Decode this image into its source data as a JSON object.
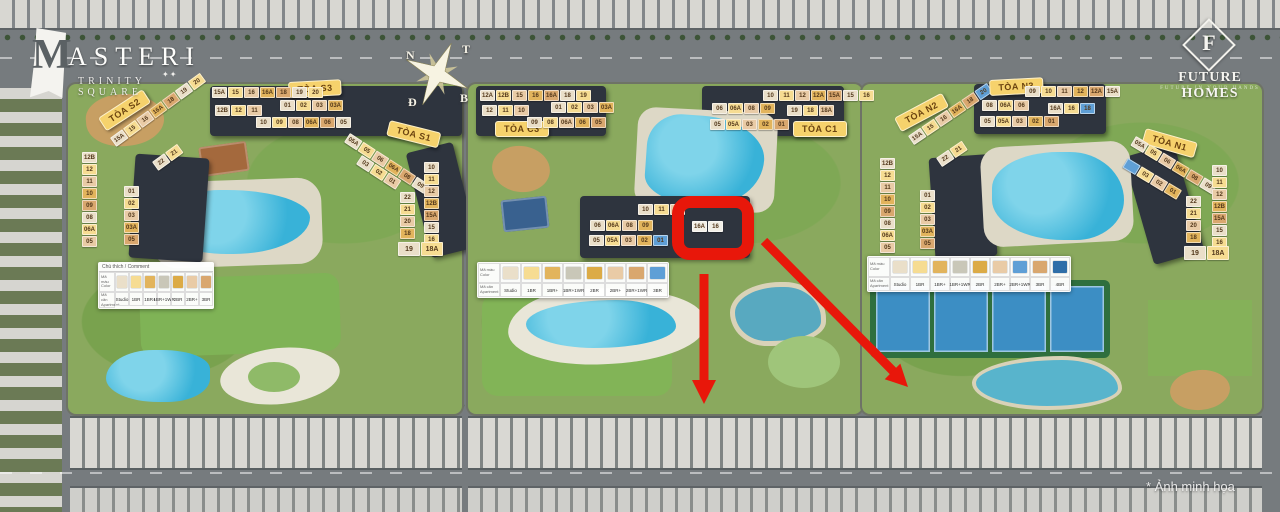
{
  "branding": {
    "masteri_m": "M",
    "masteri_rest": "ASTERI",
    "masteri_subtitle": "TRINITY SQUARE",
    "masteri_stars": "✦✦",
    "fh_monogram": "F",
    "fh_name": "FUTURE HOMES",
    "fh_tagline": "FUTURE IN YOUR HANDS"
  },
  "compass": {
    "tl": "N",
    "tr": "T",
    "bl": "Đ",
    "br": "B"
  },
  "watermark": "* Ảnh minh họa",
  "palette": {
    "st": "#eadfc9",
    "y1": "#f6dc92",
    "y2": "#e2b45c",
    "g2": "#dcab46",
    "t1": "#e9cba6",
    "t2": "#d9a76e",
    "gr": "#c9c7b8",
    "bl": "#5f9fd6",
    "b2": "#2f6ea8",
    "wh": "#f2efe6",
    "highlight_red": "#e8170a",
    "label_bg": "#f6d26c",
    "label_text": "#6b430f"
  },
  "legend_headers": {
    "color_vi": "Mã màu",
    "color_en": "Color",
    "apt_vi": "Mã căn",
    "apt_en": "Apartment"
  },
  "legends": [
    {
      "id": "left",
      "title": "Chú thích / Comment",
      "x": 98,
      "y": 262,
      "cell": 14,
      "hw": 16,
      "items": [
        {
          "label": "Studio",
          "c": "st"
        },
        {
          "label": "1BR",
          "c": "y1"
        },
        {
          "label": "1BR+",
          "c": "y2"
        },
        {
          "label": "1BR+1WR",
          "c": "gr"
        },
        {
          "label": "2BR",
          "c": "g2"
        },
        {
          "label": "2BR+",
          "c": "t1"
        },
        {
          "label": "3BR",
          "c": "t2"
        }
      ]
    },
    {
      "id": "center",
      "title": "",
      "x": 477,
      "y": 262,
      "cell": 21,
      "hw": 22,
      "items": [
        {
          "label": "Studio",
          "c": "st"
        },
        {
          "label": "1BR",
          "c": "y1"
        },
        {
          "label": "1BR+",
          "c": "y2"
        },
        {
          "label": "1BR+1WR",
          "c": "gr"
        },
        {
          "label": "2BR",
          "c": "g2"
        },
        {
          "label": "2BR+",
          "c": "t1"
        },
        {
          "label": "2BR+1WR",
          "c": "t2"
        },
        {
          "label": "3BR",
          "c": "bl"
        }
      ]
    },
    {
      "id": "right",
      "title": "",
      "x": 867,
      "y": 256,
      "cell": 20,
      "hw": 22,
      "items": [
        {
          "label": "Studio",
          "c": "st"
        },
        {
          "label": "1BR",
          "c": "y1"
        },
        {
          "label": "1BR+",
          "c": "y2"
        },
        {
          "label": "1BR+1WR",
          "c": "gr"
        },
        {
          "label": "2BR",
          "c": "g2"
        },
        {
          "label": "2BR+",
          "c": "t1"
        },
        {
          "label": "2BR+1WR",
          "c": "bl"
        },
        {
          "label": "3BR",
          "c": "t2"
        },
        {
          "label": "4BR",
          "c": "b2"
        }
      ]
    }
  ],
  "buildings": [
    {
      "id": "S2",
      "label": "TÒA S2",
      "lx": 98,
      "ly": 118,
      "lrot": -33,
      "groups": [
        {
          "x": 110,
          "y": 138,
          "rot": -36,
          "tiles": [
            "15A",
            "15",
            "16",
            "16A",
            "18",
            "19",
            "20"
          ]
        },
        {
          "x": 152,
          "y": 162,
          "rot": -36,
          "tiles": [
            "22",
            "21"
          ]
        },
        {
          "x": 82,
          "y": 152,
          "dir": "col",
          "tiles": [
            "12B",
            "12",
            "11",
            "10",
            "09",
            "08",
            "06A",
            "05"
          ]
        },
        {
          "x": 124,
          "y": 186,
          "dir": "col",
          "tiles": [
            "01",
            "02",
            "03",
            "03A",
            "05"
          ]
        }
      ]
    },
    {
      "id": "S3",
      "label": "TÒA S3",
      "lx": 288,
      "ly": 82,
      "lrot": -3,
      "groups": [
        {
          "x": 212,
          "y": 87,
          "tiles": [
            "15A",
            "15",
            "16",
            "16A",
            "18",
            "19",
            "20"
          ]
        },
        {
          "x": 215,
          "y": 105,
          "tiles": [
            "12B",
            "12",
            "11"
          ]
        },
        {
          "x": 280,
          "y": 100,
          "tiles": [
            "01",
            "02",
            "03",
            "03A"
          ]
        },
        {
          "x": 256,
          "y": 117,
          "tiles": [
            "10",
            "09",
            "08",
            "06A",
            "06",
            "05"
          ]
        }
      ]
    },
    {
      "id": "S1",
      "label": "TÒA S1",
      "lx": 390,
      "ly": 120,
      "lrot": 14,
      "groups": [
        {
          "x": 350,
          "y": 133,
          "rot": 33,
          "tiles": [
            "05A",
            "05",
            "06",
            "06A",
            "08",
            "09"
          ]
        },
        {
          "x": 362,
          "y": 155,
          "rot": 33,
          "tiles": [
            "03",
            "02",
            "01"
          ]
        },
        {
          "x": 424,
          "y": 162,
          "dir": "col",
          "tiles": [
            "10",
            "11",
            "12",
            "12B",
            "15A",
            "15",
            "16"
          ]
        },
        {
          "x": 400,
          "y": 192,
          "dir": "col",
          "tiles": [
            "22",
            "21",
            "20",
            "18"
          ]
        },
        {
          "x": 398,
          "y": 242,
          "wide": true,
          "tiles": [
            "19",
            "18A"
          ]
        }
      ]
    },
    {
      "id": "C3",
      "label": "TÒA C3",
      "lx": 495,
      "ly": 121,
      "lrot": 0,
      "groups": [
        {
          "x": 480,
          "y": 90,
          "tiles": [
            "12A",
            "12B",
            "15",
            "16",
            "16A",
            "18",
            "19"
          ]
        },
        {
          "x": 482,
          "y": 105,
          "tiles": [
            "12",
            "11",
            "10"
          ]
        },
        {
          "x": 551,
          "y": 102,
          "tiles": [
            "01",
            "02",
            "03",
            "03A"
          ]
        },
        {
          "x": 527,
          "y": 117,
          "tiles": [
            "09",
            "08",
            "06A",
            "06",
            "05"
          ]
        }
      ]
    },
    {
      "id": "C1",
      "label": "TÒA C1",
      "lx": 793,
      "ly": 121,
      "lrot": 0,
      "groups": [
        {
          "x": 763,
          "y": 90,
          "tiles": [
            "10",
            "11",
            "12",
            "12A",
            "15A",
            "15",
            "16"
          ]
        },
        {
          "x": 712,
          "y": 103,
          "tiles": [
            "06",
            "06A",
            "08",
            "09"
          ]
        },
        {
          "x": 787,
          "y": 105,
          "tiles": [
            "19",
            "18",
            "18A"
          ]
        },
        {
          "x": 710,
          "y": 119,
          "tiles": [
            "05",
            "05A",
            "03",
            "02",
            "01"
          ]
        }
      ]
    },
    {
      "id": "C2",
      "label": "",
      "groups": [
        {
          "x": 638,
          "y": 204,
          "tiles": [
            "10",
            "11",
            "12"
          ]
        },
        {
          "x": 590,
          "y": 220,
          "tiles": [
            "06",
            "06A",
            "08",
            "09"
          ]
        },
        {
          "x": 589,
          "y": 235,
          "tiles": [
            "05",
            "05A",
            "03",
            "02",
            "01|bl"
          ]
        },
        {
          "x": 692,
          "y": 221,
          "tiles": [
            "16A|wh",
            "16|wh"
          ]
        }
      ]
    },
    {
      "id": "N2",
      "label": "TÒA N2",
      "lx": 894,
      "ly": 118,
      "lrot": -28,
      "groups": [
        {
          "x": 908,
          "y": 136,
          "rot": -34,
          "tiles": [
            "15A",
            "15",
            "16",
            "16A",
            "18",
            "20|bl"
          ]
        },
        {
          "x": 936,
          "y": 158,
          "rot": -34,
          "tiles": [
            "22",
            "21"
          ]
        },
        {
          "x": 880,
          "y": 158,
          "dir": "col",
          "tiles": [
            "12B",
            "12",
            "11",
            "10",
            "09",
            "08",
            "06A",
            "05"
          ]
        },
        {
          "x": 920,
          "y": 190,
          "dir": "col",
          "tiles": [
            "01",
            "02",
            "03",
            "03A",
            "05"
          ]
        }
      ]
    },
    {
      "id": "N3",
      "label": "TÒA N3",
      "lx": 989,
      "ly": 80,
      "lrot": -3,
      "groups": [
        {
          "x": 1025,
          "y": 86,
          "tiles": [
            "09",
            "10",
            "11",
            "12",
            "12A",
            "15A"
          ]
        },
        {
          "x": 982,
          "y": 100,
          "tiles": [
            "08",
            "06A",
            "06"
          ]
        },
        {
          "x": 1048,
          "y": 103,
          "tiles": [
            "16A",
            "16",
            "18|bl"
          ]
        },
        {
          "x": 980,
          "y": 116,
          "tiles": [
            "05",
            "05A",
            "03",
            "02",
            "01"
          ]
        }
      ]
    },
    {
      "id": "N1",
      "label": "TÒA N1",
      "lx": 1146,
      "ly": 128,
      "lrot": 16,
      "groups": [
        {
          "x": 1136,
          "y": 136,
          "rot": 31,
          "tiles": [
            "05A",
            "05",
            "06",
            "06A",
            "08",
            "09"
          ]
        },
        {
          "x": 1128,
          "y": 158,
          "rot": 31,
          "tiles": [
            "|bl",
            "03",
            "02",
            "01"
          ]
        },
        {
          "x": 1212,
          "y": 165,
          "dir": "col",
          "tiles": [
            "10",
            "11",
            "12",
            "12B",
            "15A",
            "15",
            "16"
          ]
        },
        {
          "x": 1186,
          "y": 196,
          "dir": "col",
          "tiles": [
            "22",
            "21",
            "20",
            "18"
          ]
        },
        {
          "x": 1184,
          "y": 246,
          "wide": true,
          "tiles": [
            "19",
            "18A"
          ]
        }
      ]
    }
  ],
  "annotations": {
    "highlighted_units": [
      "16A",
      "16"
    ],
    "highlight_building": "C2"
  }
}
